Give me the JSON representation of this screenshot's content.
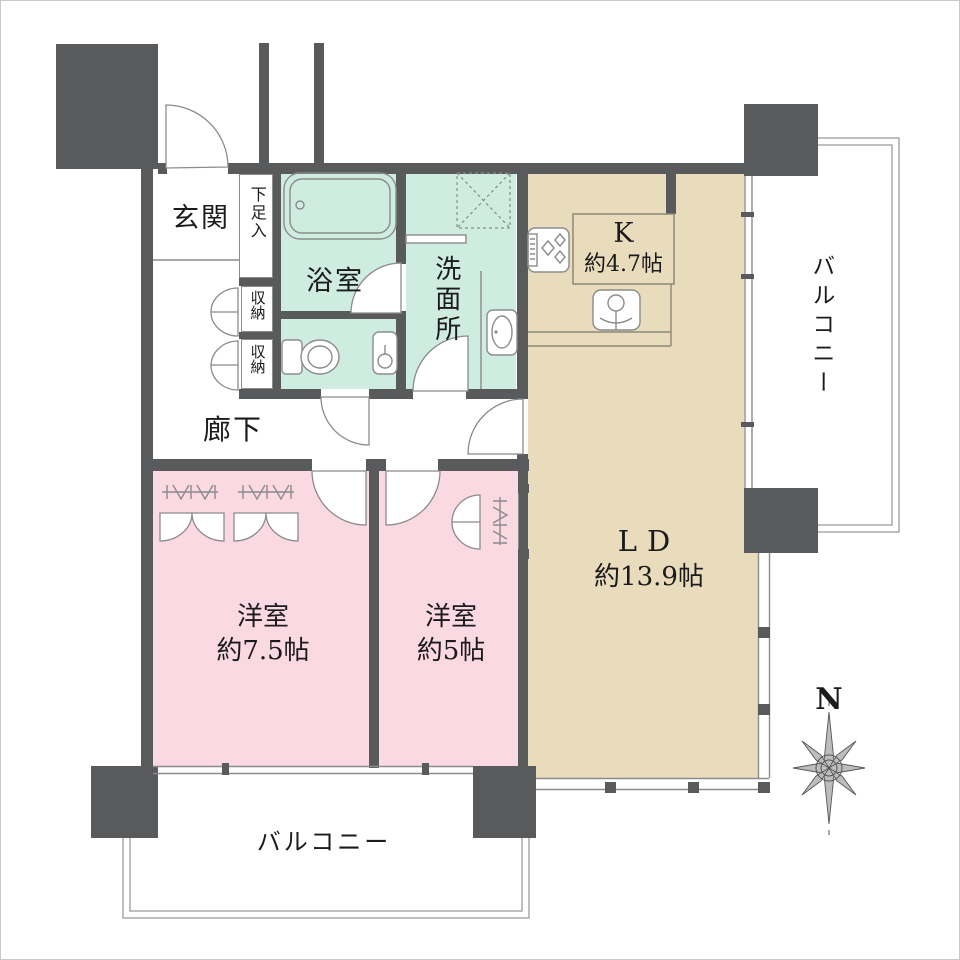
{
  "colors": {
    "wall": "#595a5c",
    "mint": "#cfece1",
    "tan": "#e9dcbd",
    "pink": "#fbd9e3",
    "line": "#8b8b8b",
    "bline": "#9a9a9a",
    "ink": "#1b1b1b",
    "kline": "#8d8878"
  },
  "rooms": {
    "genkan": {
      "label": "玄関"
    },
    "shoe": {
      "label": "下足入"
    },
    "bath": {
      "label": "浴室"
    },
    "wash": {
      "label": "洗面所"
    },
    "storage1": {
      "label": "収納"
    },
    "storage2": {
      "label": "収納"
    },
    "hall": {
      "label": "廊下"
    },
    "kitchen": {
      "label": "K",
      "size": "約4.7帖"
    },
    "ld": {
      "label": "LD",
      "size": "約13.9帖"
    },
    "bed1": {
      "label": "洋室",
      "size": "約7.5帖"
    },
    "bed2": {
      "label": "洋室",
      "size": "約5帖"
    },
    "balcony_right": {
      "label": "バルコニー"
    },
    "balcony_bottom": {
      "label": "バルコニー"
    }
  },
  "compass": {
    "label": "N"
  }
}
